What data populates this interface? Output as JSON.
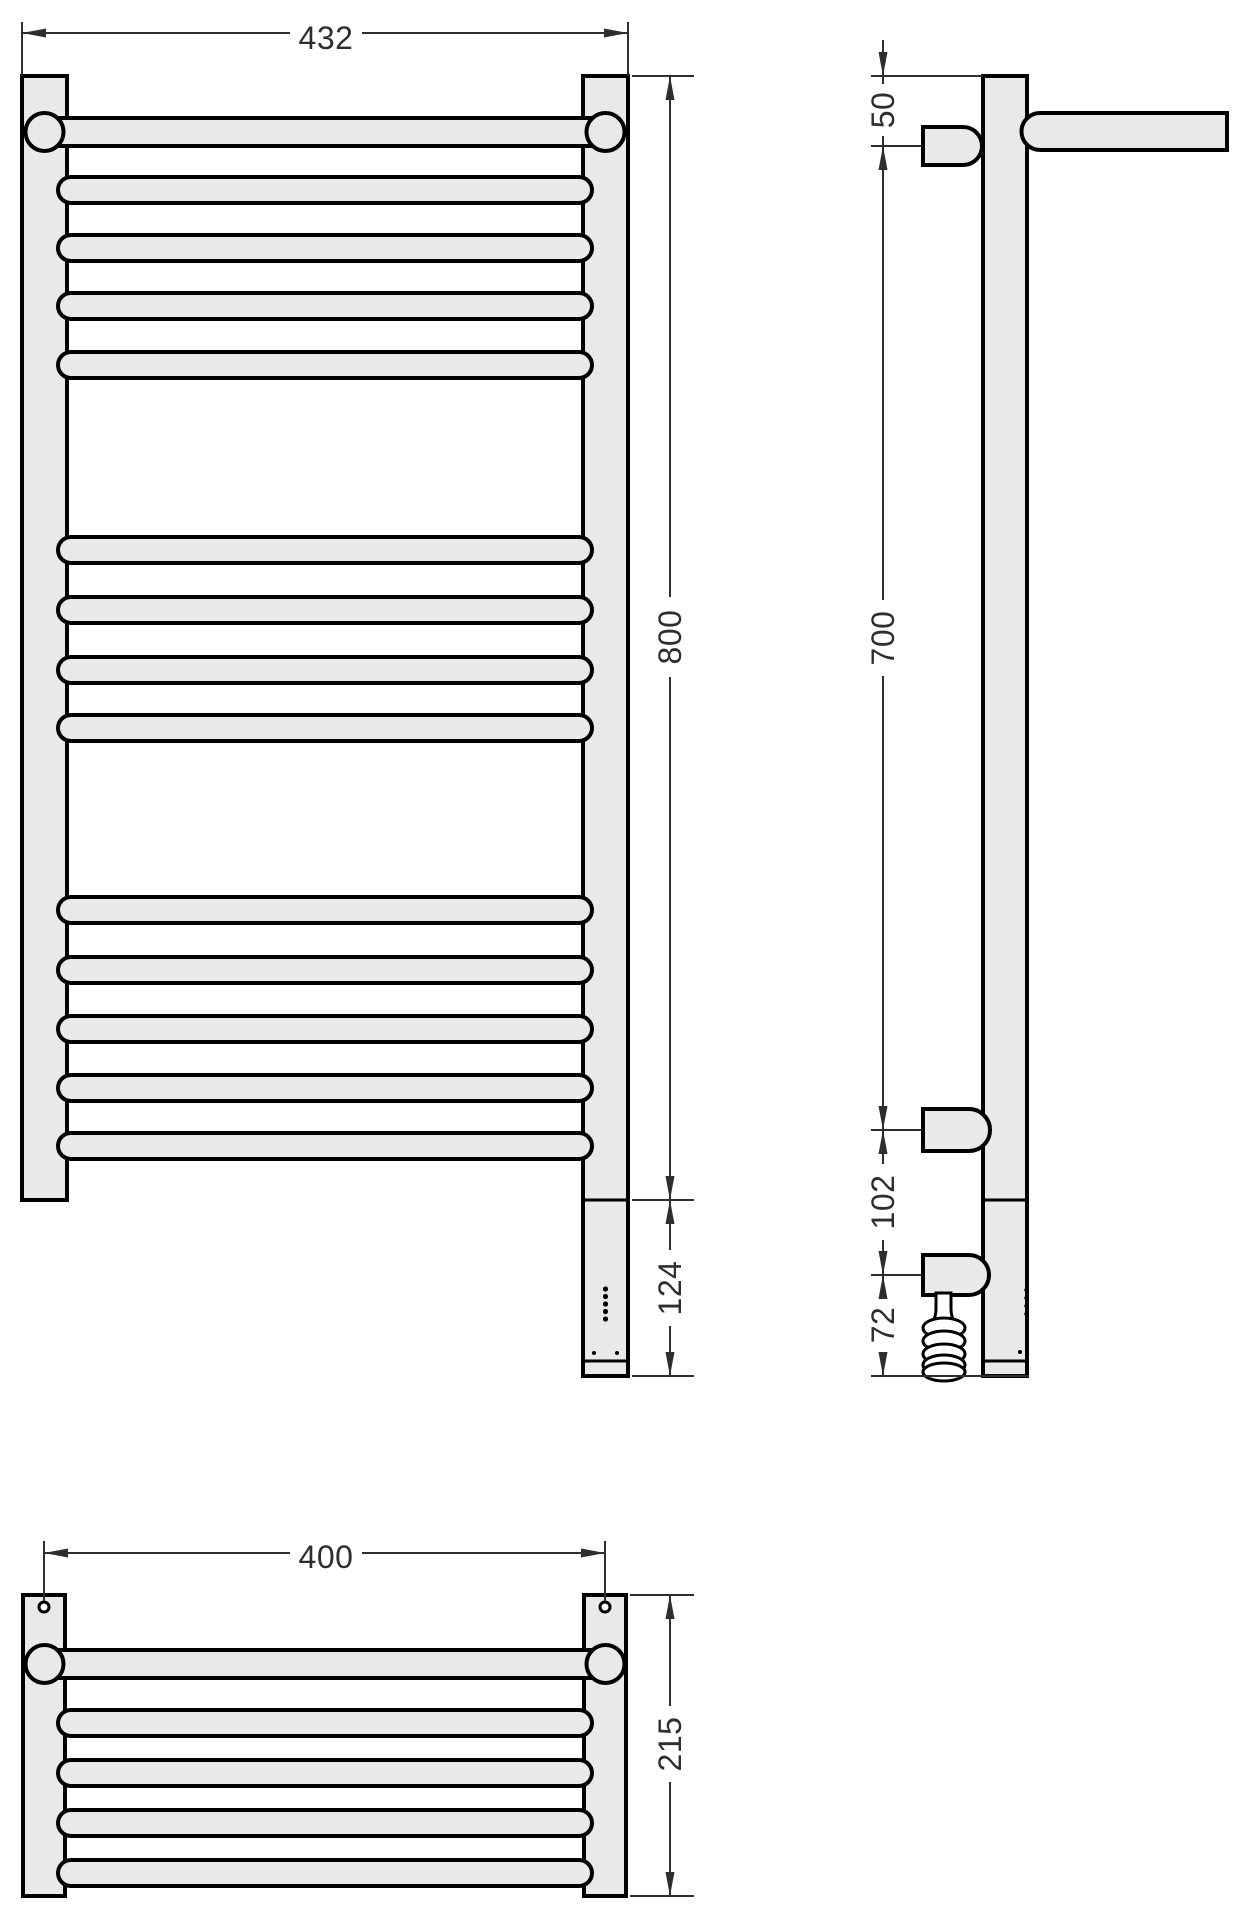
{
  "drawing": {
    "front_view": {
      "overall_width": "432",
      "overall_height": "800",
      "heater_section_height": "124"
    },
    "side_view": {
      "top_to_first_rail": "50",
      "rail_span": "700",
      "lower_union_gap": "102",
      "heater_bottom_gap": "72"
    },
    "plan_view": {
      "mounting_width": "400",
      "overall_depth": "215"
    }
  }
}
